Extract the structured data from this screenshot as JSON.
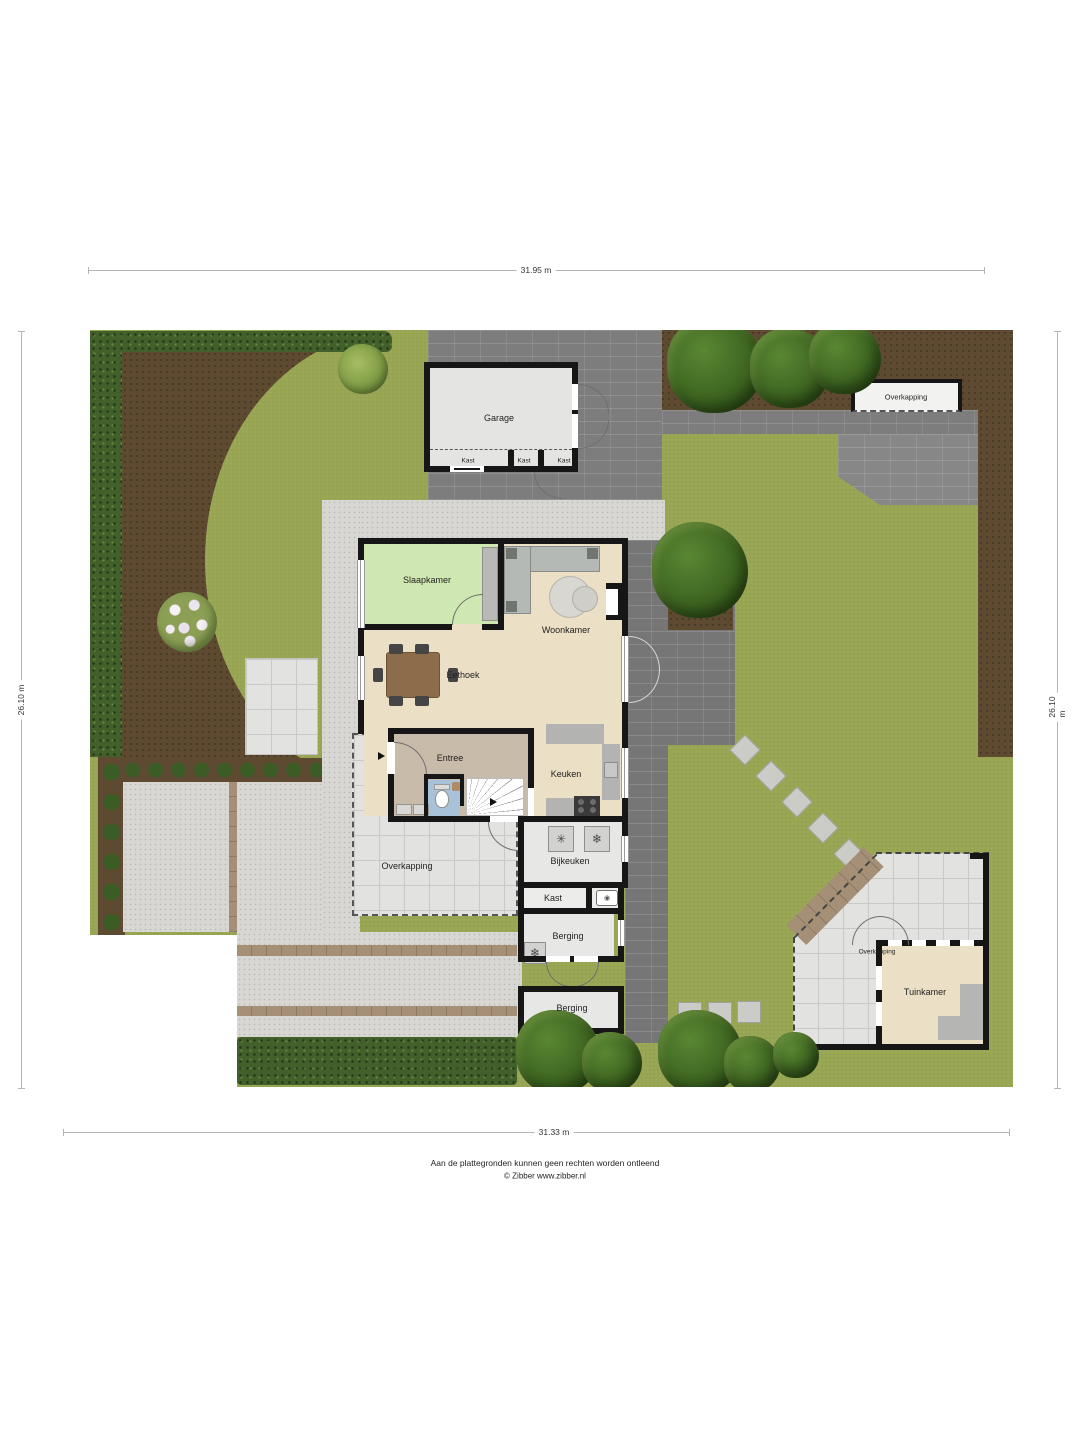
{
  "title": "Situatie plattegrond",
  "dimensions": {
    "top": "31.95 m",
    "bottom": "31.33 m",
    "left": "26.10 m",
    "right": "26.10 m"
  },
  "labels": {
    "garage": "Garage",
    "garage_kast_1": "Kast",
    "garage_kast_2": "Kast",
    "garage_kast_3": "Kast",
    "overkapping_north": "Overkapping",
    "slaapkamer": "Slaapkamer",
    "woonkamer": "Woonkamer",
    "eethoek": "Eethoek",
    "entree": "Entree",
    "keuken": "Keuken",
    "overkapping_house": "Overkapping",
    "bijkeuken": "Bijkeuken",
    "kast": "Kast",
    "berging_north": "Berging",
    "berging_south": "Berging",
    "overkapping_garden": "Overkapping",
    "tuinkamer": "Tuinkamer"
  },
  "icons": {
    "dishwasher": "✳",
    "dryer": "❄",
    "freezer": "❄",
    "boiler": "◉"
  },
  "footer": {
    "disclaimer": "Aan de plattegronden kunnen geen rechten worden ontleend",
    "copyright": "© Zibber www.zibber.nl"
  },
  "colors": {
    "grass": "#97a451",
    "soil": "#5d4a31",
    "hedge": "#41602a",
    "paving": "#7d7d7d",
    "gravel": "#d8d7d4",
    "tile": "#e2e2e0",
    "wall": "#161616",
    "floor_cream": "#ebdfc5",
    "floor_green": "#cfe7b0",
    "floor_tan": "#c9bbaa",
    "floor_blue": "#a8c2d9",
    "floor_gray": "#e7e7e5",
    "wood": "#8d6c4b",
    "brick": "#a59077"
  }
}
